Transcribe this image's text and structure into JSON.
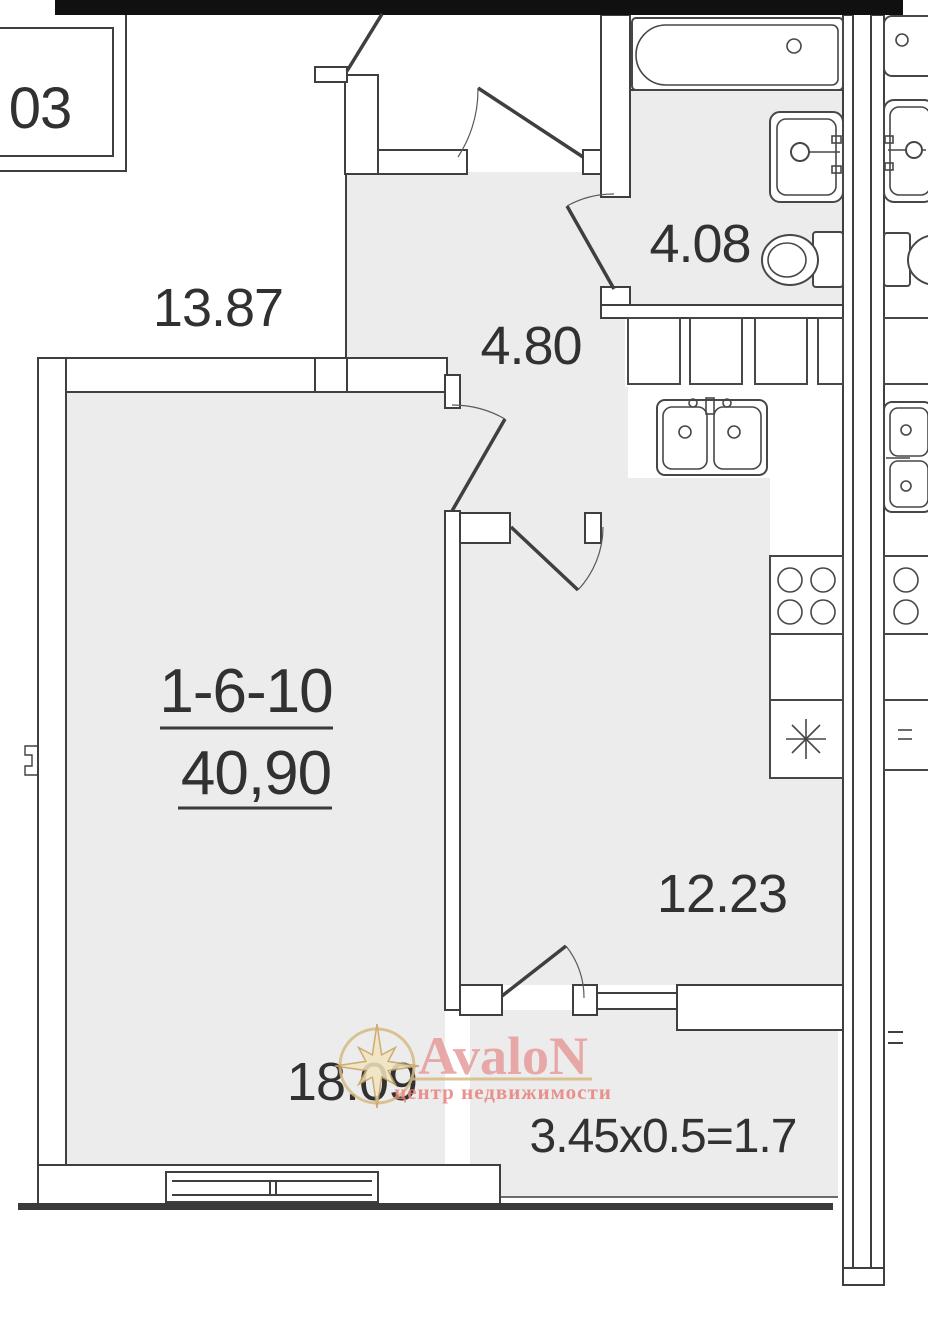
{
  "plan": {
    "neighbor_unit_label": "03",
    "unit_number": "1-6-10",
    "total_area": "40,90",
    "areas": {
      "room_top": "13.87",
      "hallway": "4.80",
      "bathroom": "4.08",
      "kitchen": "12.23",
      "living_room": "18.09",
      "balcony_formula": "3.45x0.5=1.7"
    }
  },
  "watermark": {
    "brand": "AvaloN",
    "tagline": "центр недвижимости",
    "brand_color": "#e79c9c",
    "tagline_color": "#e8807b",
    "gold": "#d6ba84"
  },
  "colors": {
    "floor_fill": "#ececec",
    "wall_line": "#3f3f3f",
    "outer_wall": "#101010"
  }
}
